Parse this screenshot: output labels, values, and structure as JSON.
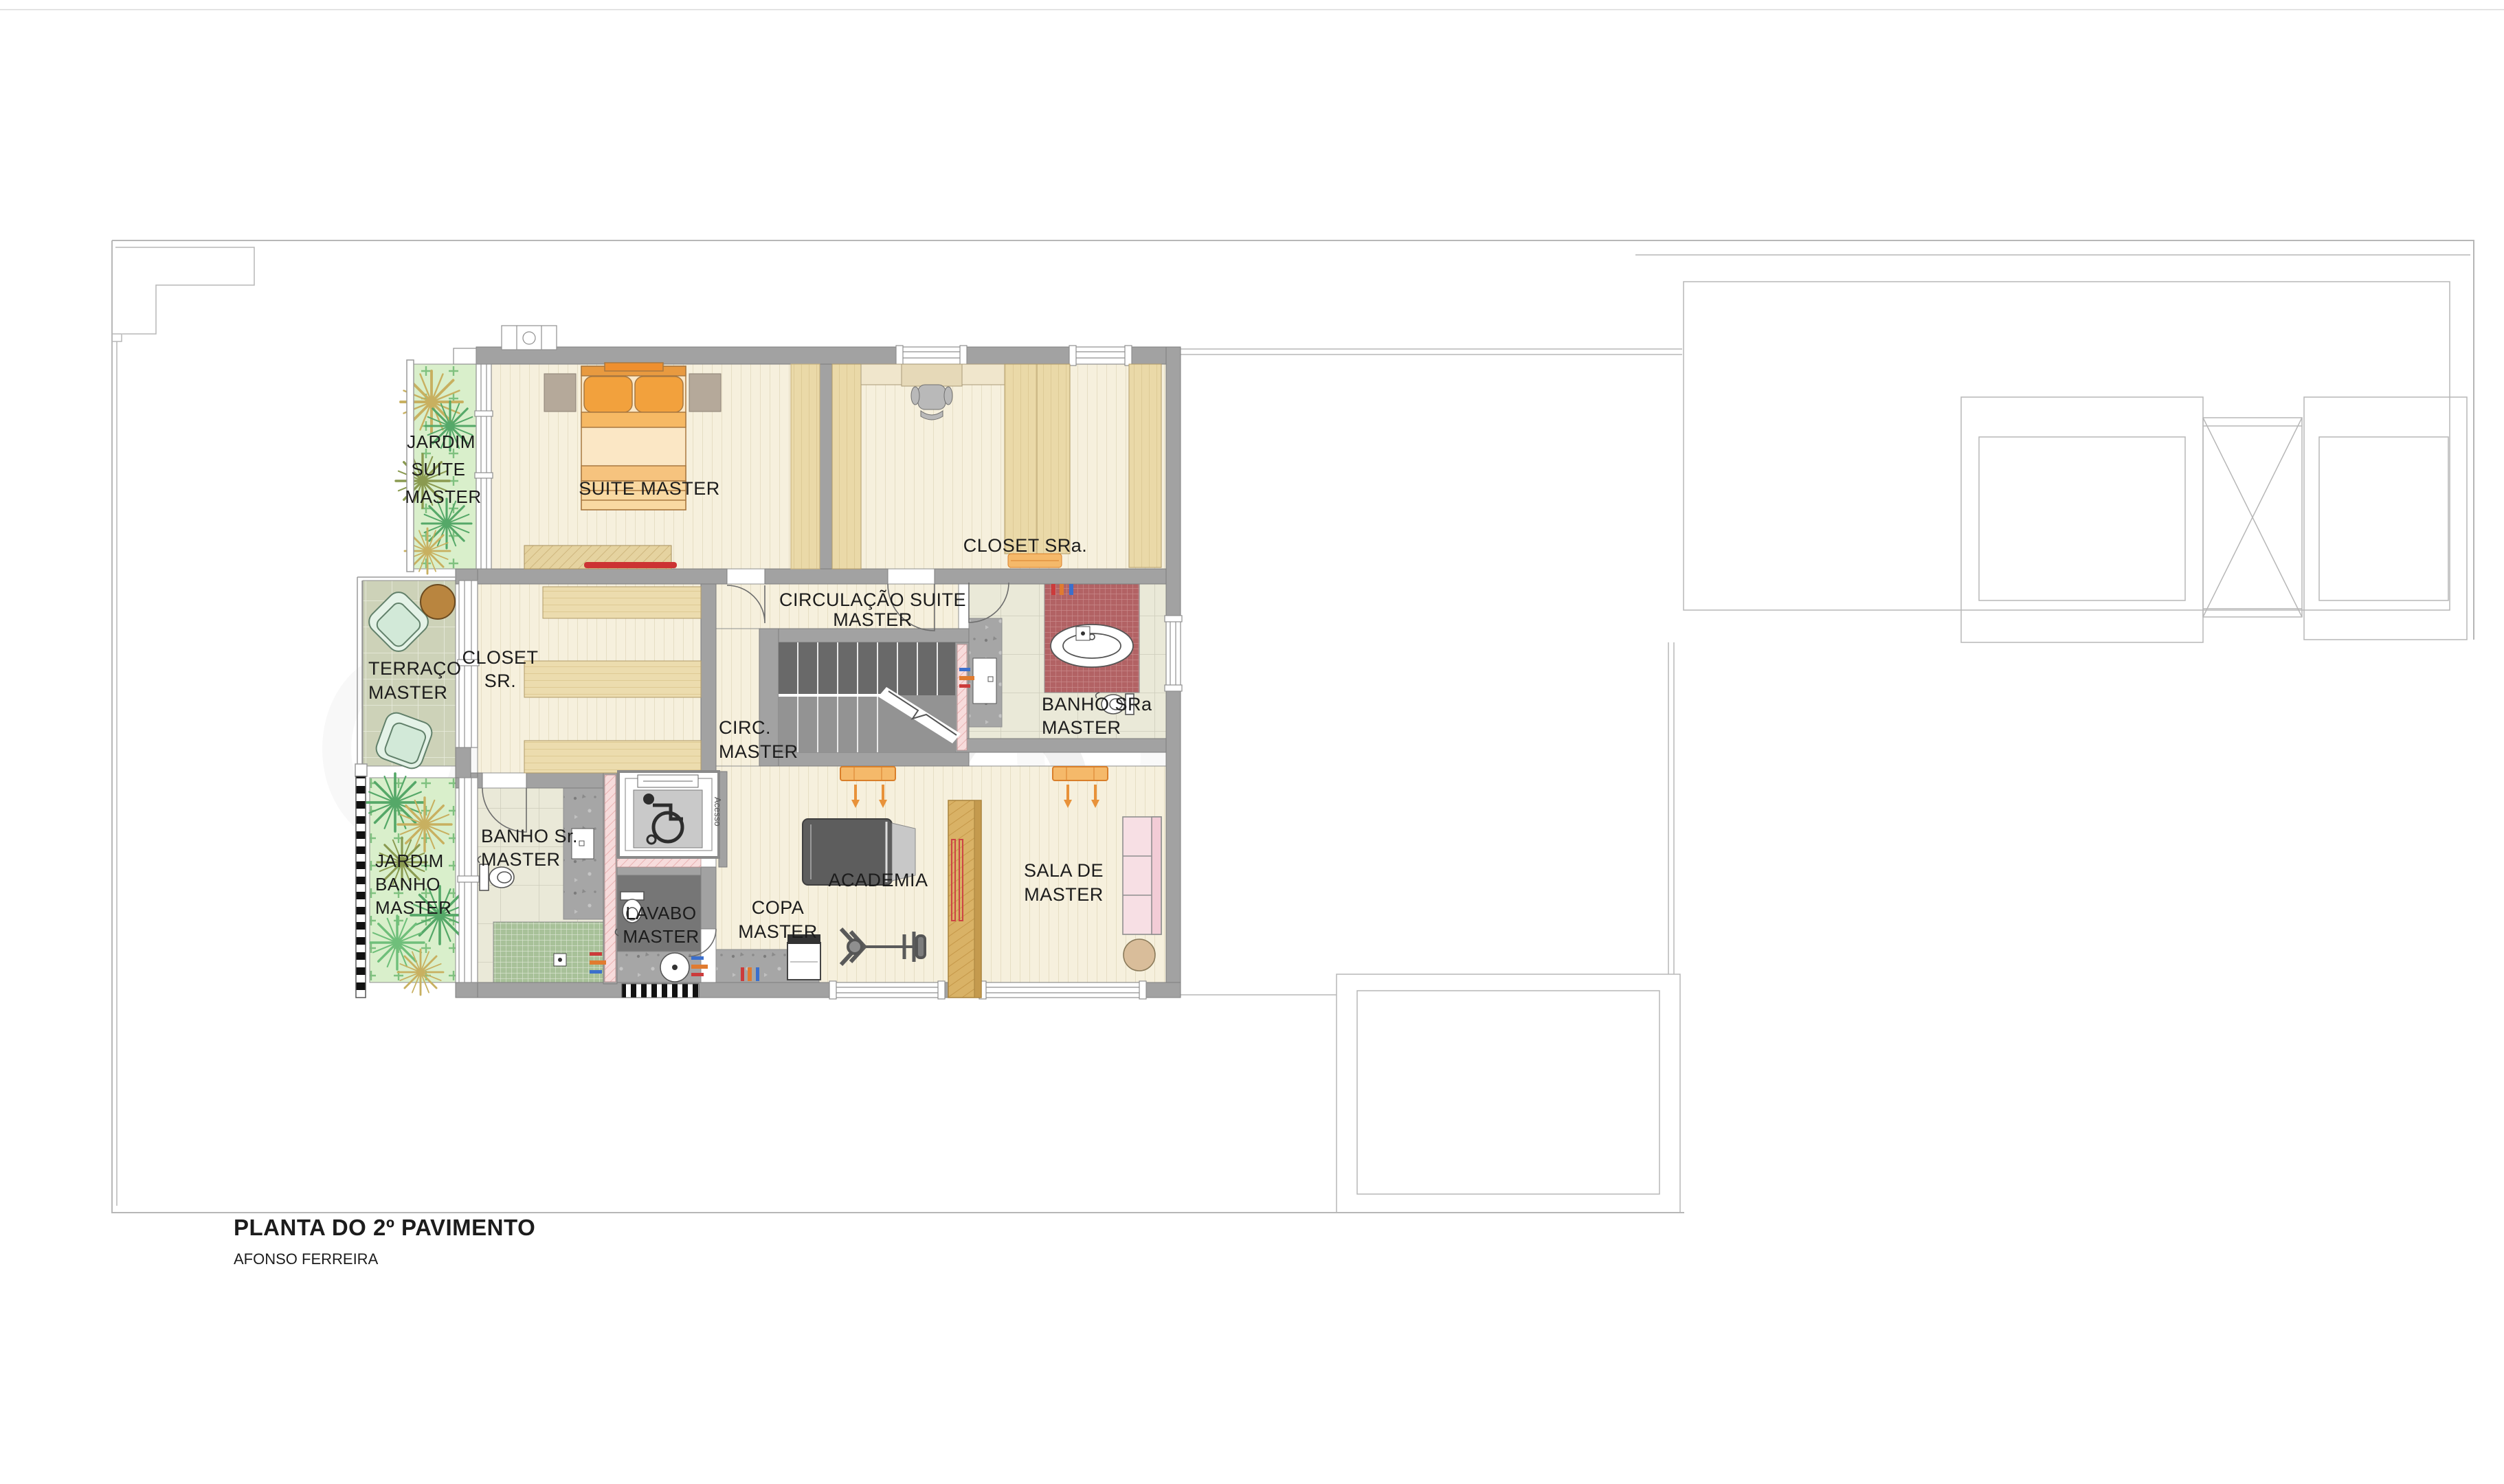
{
  "title_block": {
    "title": "PLANTA DO 2º PAVIMENTO",
    "subtitle": "AFONSO FERREIRA"
  },
  "rooms": {
    "jardim_suite": {
      "line1": "JARDIM",
      "line2": "SUITE",
      "line3": "MASTER"
    },
    "suite_master": {
      "line1": "SUITE MASTER"
    },
    "closet_sra": {
      "line1": "CLOSET SRa."
    },
    "circulacao_suite": {
      "line1": "CIRCULAÇÃO SUITE",
      "line2": "MASTER"
    },
    "terraco_master": {
      "line1": "TERRAÇO",
      "line2": "MASTER"
    },
    "closet_sr": {
      "line1": "CLOSET",
      "line2": "SR."
    },
    "circ_master": {
      "line1": "CIRC.",
      "line2": "MASTER"
    },
    "banho_sra": {
      "line1": "BANHO SRa",
      "line2": "MASTER"
    },
    "jardim_banho": {
      "line1": "JARDIM",
      "line2": "BANHO",
      "line3": "MASTER"
    },
    "banho_sr": {
      "line1": "BANHO Sr.",
      "line2": "MASTER"
    },
    "lavabo": {
      "line1": "LAVABO",
      "line2": "MASTER"
    },
    "copa": {
      "line1": "COPA",
      "line2": "MASTER"
    },
    "academia": {
      "line1": "ACADEMIA"
    },
    "sala": {
      "line1": "SALA DE",
      "line2": "MASTER"
    }
  },
  "annotations": {
    "elevator_access": "Acesso",
    "watermark": "HO"
  },
  "colors": {
    "wall": "#a2a2a2",
    "floor_plank": "#f6f0dd",
    "wardrobe_tan": "#ead9a8",
    "garden_green": "#d9efcb",
    "terrace_sage": "#cdd2b8",
    "bath_tile": "#eae9d8",
    "mosaic_red": "#b26264",
    "mosaic_green": "#a8c199",
    "concrete": "#a6a6a6",
    "pink_wet_wall": "#f7dcdc",
    "sofa_pink": "#f7dfe4",
    "wood_panel": "#d9b266",
    "accent_orange": "#e8923a",
    "dark_floor": "#767676"
  }
}
